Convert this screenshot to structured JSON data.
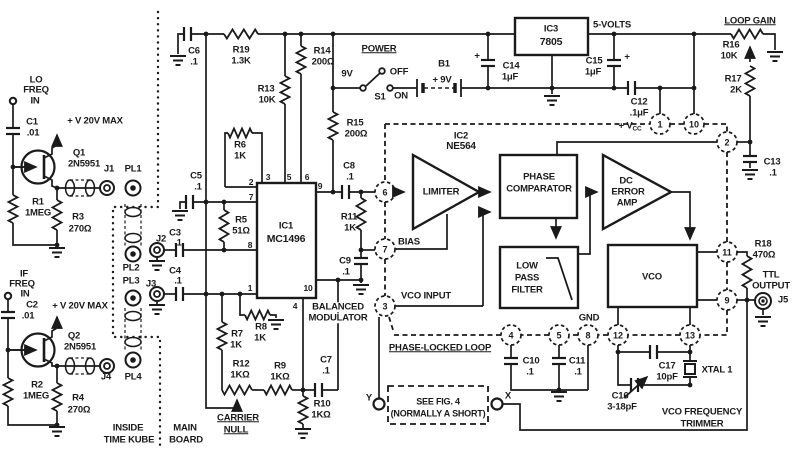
{
  "colors": {
    "ink": "#1a1a1a",
    "background": "#ffffff"
  },
  "labels": [
    {
      "id": "lo-1",
      "t": "LO",
      "x": 36,
      "y": 80
    },
    {
      "id": "lo-2",
      "t": "FREQ",
      "x": 36,
      "y": 90
    },
    {
      "id": "lo-3",
      "t": "IN",
      "x": 35,
      "y": 101
    },
    {
      "id": "c1-ref",
      "t": "C1",
      "x": 32,
      "y": 122
    },
    {
      "id": "c1-val",
      "t": ".01",
      "x": 33,
      "y": 133
    },
    {
      "id": "vmax-1",
      "t": "+ V 20V MAX",
      "x": 95,
      "y": 121
    },
    {
      "id": "q1-ref",
      "t": "Q1",
      "x": 79,
      "y": 153
    },
    {
      "id": "q1-val",
      "t": "2N5951",
      "x": 84,
      "y": 164
    },
    {
      "id": "j1-l",
      "t": "J1",
      "x": 109,
      "y": 169
    },
    {
      "id": "pl1-l",
      "t": "PL1",
      "x": 133,
      "y": 169
    },
    {
      "id": "r1-ref",
      "t": "R1",
      "x": 38,
      "y": 202
    },
    {
      "id": "r1-val",
      "t": "1MEG",
      "x": 38,
      "y": 213
    },
    {
      "id": "r3-ref",
      "t": "R3",
      "x": 78,
      "y": 217
    },
    {
      "id": "r3-val",
      "t": "270Ω",
      "x": 80,
      "y": 229
    },
    {
      "id": "if-1",
      "t": "IF",
      "x": 24,
      "y": 274
    },
    {
      "id": "if-2",
      "t": "FREQ",
      "x": 22,
      "y": 284
    },
    {
      "id": "if-3",
      "t": "IN",
      "x": 25,
      "y": 294
    },
    {
      "id": "c2-ref",
      "t": "C2",
      "x": 32,
      "y": 305
    },
    {
      "id": "c2-val",
      "t": ".01",
      "x": 28,
      "y": 316
    },
    {
      "id": "vmax-2",
      "t": "+ V 20V MAX",
      "x": 80,
      "y": 306
    },
    {
      "id": "q2-ref",
      "t": "Q2",
      "x": 74,
      "y": 336
    },
    {
      "id": "q2-val",
      "t": "2N5951",
      "x": 80,
      "y": 347
    },
    {
      "id": "j4-l",
      "t": "J4",
      "x": 106,
      "y": 377
    },
    {
      "id": "pl4-l",
      "t": "PL4",
      "x": 133,
      "y": 377
    },
    {
      "id": "r2-ref",
      "t": "R2",
      "x": 37,
      "y": 385
    },
    {
      "id": "r2-val",
      "t": "1MEG",
      "x": 36,
      "y": 396
    },
    {
      "id": "r4-ref",
      "t": "R4",
      "x": 78,
      "y": 398
    },
    {
      "id": "r4-val",
      "t": "270Ω",
      "x": 79,
      "y": 410
    },
    {
      "id": "pl2-l",
      "t": "PL2",
      "x": 131,
      "y": 268
    },
    {
      "id": "pl3-l",
      "t": "PL3",
      "x": 131,
      "y": 281
    },
    {
      "id": "j2-l",
      "t": "J2",
      "x": 161,
      "y": 239
    },
    {
      "id": "j3-l",
      "t": "J3",
      "x": 151,
      "y": 284
    },
    {
      "id": "inside-1",
      "t": "INSIDE",
      "x": 128,
      "y": 428
    },
    {
      "id": "inside-2",
      "t": "TIME KUBE",
      "x": 129,
      "y": 440
    },
    {
      "id": "main-1",
      "t": "MAIN",
      "x": 185,
      "y": 428
    },
    {
      "id": "main-2",
      "t": "BOARD",
      "x": 186,
      "y": 440
    },
    {
      "id": "c6-ref",
      "t": "C6",
      "x": 194,
      "y": 51
    },
    {
      "id": "c6-val",
      "t": ".1",
      "x": 194,
      "y": 62
    },
    {
      "id": "r19-ref",
      "t": "R19",
      "x": 241,
      "y": 50
    },
    {
      "id": "r19-val",
      "t": "1.3K",
      "x": 241,
      "y": 61
    },
    {
      "id": "r13-ref",
      "t": "R13",
      "x": 266,
      "y": 89
    },
    {
      "id": "r13-val",
      "t": "10K",
      "x": 267,
      "y": 100
    },
    {
      "id": "r14-ref",
      "t": "R14",
      "x": 322,
      "y": 51
    },
    {
      "id": "r14-val",
      "t": "200Ω",
      "x": 323,
      "y": 62
    },
    {
      "id": "r6-ref",
      "t": "R6",
      "x": 240,
      "y": 145
    },
    {
      "id": "r6-val",
      "t": "1K",
      "x": 240,
      "y": 156
    },
    {
      "id": "c5-ref",
      "t": "C5",
      "x": 196,
      "y": 176
    },
    {
      "id": "c5-val",
      "t": ".1",
      "x": 198,
      "y": 187
    },
    {
      "id": "r5-ref",
      "t": "R5",
      "x": 241,
      "y": 220
    },
    {
      "id": "r5-val",
      "t": "51Ω",
      "x": 241,
      "y": 231
    },
    {
      "id": "c3-ref",
      "t": "C3",
      "x": 175,
      "y": 233
    },
    {
      "id": "c3-val",
      "t": ".1",
      "x": 178,
      "y": 243
    },
    {
      "id": "c4-ref",
      "t": "C4",
      "x": 175,
      "y": 271
    },
    {
      "id": "c4-val",
      "t": ".1",
      "x": 178,
      "y": 281
    },
    {
      "id": "r7-ref",
      "t": "R7",
      "x": 237,
      "y": 334
    },
    {
      "id": "r7-val",
      "t": "1K",
      "x": 236,
      "y": 345
    },
    {
      "id": "r8-ref",
      "t": "R8",
      "x": 261,
      "y": 327
    },
    {
      "id": "r8-val",
      "t": "1K",
      "x": 260,
      "y": 338
    },
    {
      "id": "r12-ref",
      "t": "R12",
      "x": 241,
      "y": 364
    },
    {
      "id": "r12-val",
      "t": "1KΩ",
      "x": 240,
      "y": 375
    },
    {
      "id": "r9-ref",
      "t": "R9",
      "x": 280,
      "y": 366
    },
    {
      "id": "r9-val",
      "t": "1KΩ",
      "x": 280,
      "y": 377
    },
    {
      "id": "r10-ref",
      "t": "R10",
      "x": 322,
      "y": 404
    },
    {
      "id": "r10-val",
      "t": "1KΩ",
      "x": 321,
      "y": 415
    },
    {
      "id": "c7-ref",
      "t": "C7",
      "x": 326,
      "y": 360
    },
    {
      "id": "c7-val",
      "t": ".1",
      "x": 326,
      "y": 371
    },
    {
      "id": "carrier-1",
      "t": "CARRIER",
      "x": 238,
      "y": 418,
      "u": 1
    },
    {
      "id": "carrier-2",
      "t": "NULL",
      "x": 236,
      "y": 430,
      "u": 1
    },
    {
      "id": "ic1-ref",
      "t": "IC1",
      "x": 286,
      "y": 226
    },
    {
      "id": "ic1-val",
      "t": "MC1496",
      "x": 286,
      "y": 239,
      "fs": 10.5
    },
    {
      "id": "bal-1",
      "t": "BALANCED",
      "x": 338,
      "y": 307,
      "bg": 1
    },
    {
      "id": "bal-2",
      "t": "MODULATOR",
      "x": 338,
      "y": 318,
      "bg": 1
    },
    {
      "id": "ic1-p2",
      "t": "2",
      "x": 251,
      "y": 182,
      "fs": 8.5
    },
    {
      "id": "ic1-p7",
      "t": "7",
      "x": 251,
      "y": 197,
      "fs": 8.5
    },
    {
      "id": "ic1-p8",
      "t": "8",
      "x": 250,
      "y": 245,
      "fs": 8.5
    },
    {
      "id": "ic1-p1",
      "t": "1",
      "x": 250,
      "y": 288,
      "fs": 8.5
    },
    {
      "id": "ic1-p3",
      "t": "3",
      "x": 268,
      "y": 177,
      "fs": 8.5
    },
    {
      "id": "ic1-p5",
      "t": "5",
      "x": 289,
      "y": 177,
      "fs": 8.5
    },
    {
      "id": "ic1-p6",
      "t": "6",
      "x": 307,
      "y": 177,
      "fs": 8.5
    },
    {
      "id": "ic1-p9",
      "t": "9",
      "x": 320,
      "y": 186,
      "fs": 8.5
    },
    {
      "id": "ic1-p10",
      "t": "10",
      "x": 308,
      "y": 288,
      "fs": 8.5
    },
    {
      "id": "ic1-p4",
      "t": "4",
      "x": 295,
      "y": 306,
      "fs": 8.5
    },
    {
      "id": "r15-ref",
      "t": "R15",
      "x": 355,
      "y": 123
    },
    {
      "id": "r15-val",
      "t": "200Ω",
      "x": 356,
      "y": 134
    },
    {
      "id": "c8-ref",
      "t": "C8",
      "x": 349,
      "y": 166
    },
    {
      "id": "c8-val",
      "t": ".1",
      "x": 350,
      "y": 177
    },
    {
      "id": "r11-ref",
      "t": "R11",
      "x": 349,
      "y": 217
    },
    {
      "id": "r11-val",
      "t": "1K",
      "x": 350,
      "y": 228
    },
    {
      "id": "c9-ref",
      "t": "C9",
      "x": 345,
      "y": 261
    },
    {
      "id": "c9-val",
      "t": ".1",
      "x": 346,
      "y": 272
    },
    {
      "id": "power-l",
      "t": "POWER",
      "x": 379,
      "y": 49,
      "u": 1
    },
    {
      "id": "v9-l",
      "t": "9V",
      "x": 347,
      "y": 74
    },
    {
      "id": "off-l",
      "t": "OFF",
      "x": 399,
      "y": 72
    },
    {
      "id": "s1-l",
      "t": "S1",
      "x": 380,
      "y": 97
    },
    {
      "id": "on-l",
      "t": "ON",
      "x": 401,
      "y": 96
    },
    {
      "id": "b1-ref",
      "t": "B1",
      "x": 444,
      "y": 64
    },
    {
      "id": "b1-val",
      "t": "+ 9V",
      "x": 442,
      "y": 80
    },
    {
      "id": "c14-plus",
      "t": "+",
      "x": 477,
      "y": 56
    },
    {
      "id": "c14-ref",
      "t": "C14",
      "x": 511,
      "y": 66
    },
    {
      "id": "c14-val",
      "t": "1μF",
      "x": 510,
      "y": 77
    },
    {
      "id": "ic3-ref",
      "t": "IC3",
      "x": 551,
      "y": 29
    },
    {
      "id": "ic3-val",
      "t": "7805",
      "x": 551,
      "y": 42,
      "fs": 10.5
    },
    {
      "id": "v5-l",
      "t": "5-VOLTS",
      "x": 612,
      "y": 25
    },
    {
      "id": "c15-ref",
      "t": "C15",
      "x": 594,
      "y": 61
    },
    {
      "id": "c15-val",
      "t": "1μF",
      "x": 593,
      "y": 72
    },
    {
      "id": "c15-plus",
      "t": "+",
      "x": 627,
      "y": 57
    },
    {
      "id": "c12-ref",
      "t": "C12",
      "x": 639,
      "y": 102
    },
    {
      "id": "c12-val",
      "t": ".1μF",
      "x": 639,
      "y": 113
    },
    {
      "id": "vcc-l",
      "t": "+ V",
      "sub": "CC",
      "x": 630,
      "y": 127
    },
    {
      "id": "loopgain-l",
      "t": "LOOP GAIN",
      "x": 750,
      "y": 21,
      "u": 1
    },
    {
      "id": "r16-ref",
      "t": "R16",
      "x": 731,
      "y": 45
    },
    {
      "id": "r16-val",
      "t": "10K",
      "x": 729,
      "y": 56
    },
    {
      "id": "r17-ref",
      "t": "R17",
      "x": 733,
      "y": 79
    },
    {
      "id": "r17-val",
      "t": "2K",
      "x": 736,
      "y": 90
    },
    {
      "id": "ic2-ref",
      "t": "IC2",
      "x": 461,
      "y": 136
    },
    {
      "id": "ic2-val",
      "t": "NE564",
      "x": 461,
      "y": 147,
      "fs": 10
    },
    {
      "id": "limiter-l",
      "t": "LIMITER",
      "x": 441,
      "y": 192
    },
    {
      "id": "pc-1",
      "t": "PHASE",
      "x": 539,
      "y": 177
    },
    {
      "id": "pc-2",
      "t": "COMPARATOR",
      "x": 539,
      "y": 189
    },
    {
      "id": "dc-1",
      "t": "DC",
      "x": 626,
      "y": 181
    },
    {
      "id": "dc-2",
      "t": "ERROR",
      "x": 628,
      "y": 192
    },
    {
      "id": "dc-3",
      "t": "AMP",
      "x": 627,
      "y": 203
    },
    {
      "id": "lpf-1",
      "t": "LOW",
      "x": 527,
      "y": 266
    },
    {
      "id": "lpf-2",
      "t": "PASS",
      "x": 527,
      "y": 278
    },
    {
      "id": "lpf-3",
      "t": "FILTER",
      "x": 527,
      "y": 290
    },
    {
      "id": "vco-l",
      "t": "VCO",
      "x": 652,
      "y": 277
    },
    {
      "id": "bias-l",
      "t": "BIAS",
      "x": 409,
      "y": 242
    },
    {
      "id": "vcoin-l",
      "t": "VCO INPUT",
      "x": 426,
      "y": 296
    },
    {
      "id": "pll-l",
      "t": "PHASE-LOCKED LOOP",
      "x": 440,
      "y": 348,
      "u": 1
    },
    {
      "id": "gnd-l",
      "t": "GND",
      "x": 589,
      "y": 318
    },
    {
      "id": "c10-ref",
      "t": "C10",
      "x": 531,
      "y": 361
    },
    {
      "id": "c10-val",
      "t": ".1",
      "x": 530,
      "y": 372
    },
    {
      "id": "c11-ref",
      "t": "C11",
      "x": 577,
      "y": 361
    },
    {
      "id": "c11-val",
      "t": ".1",
      "x": 578,
      "y": 372
    },
    {
      "id": "c13-ref",
      "t": "C13",
      "x": 772,
      "y": 162
    },
    {
      "id": "c13-val",
      "t": ".1",
      "x": 773,
      "y": 173
    },
    {
      "id": "r18-ref",
      "t": "R18",
      "x": 763,
      "y": 244
    },
    {
      "id": "r18-val",
      "t": "470Ω",
      "x": 764,
      "y": 255
    },
    {
      "id": "ttl-1",
      "t": "TTL",
      "x": 771,
      "y": 275
    },
    {
      "id": "ttl-2",
      "t": "OUTPUT",
      "x": 771,
      "y": 286
    },
    {
      "id": "j5-l",
      "t": "J5",
      "x": 783,
      "y": 300
    },
    {
      "id": "c17-ref",
      "t": "C17",
      "x": 667,
      "y": 366
    },
    {
      "id": "c17-val",
      "t": "10pF",
      "x": 667,
      "y": 377
    },
    {
      "id": "xtal-l",
      "t": "XTAL 1",
      "x": 717,
      "y": 370
    },
    {
      "id": "c16-ref",
      "t": "C16",
      "x": 620,
      "y": 396
    },
    {
      "id": "c16-val",
      "t": "3-18pF",
      "x": 622,
      "y": 407
    },
    {
      "id": "vft-1",
      "t": "VCO FREQUENCY",
      "x": 702,
      "y": 412,
      "bg": 1
    },
    {
      "id": "vft-2",
      "t": "TRIMMER",
      "x": 702,
      "y": 424
    },
    {
      "id": "fig4-1",
      "t": "SEE FIG. 4",
      "x": 438,
      "y": 402,
      "fs": 9
    },
    {
      "id": "fig4-2",
      "t": "(NORMALLY A SHORT)",
      "x": 438,
      "y": 414,
      "fs": 9
    },
    {
      "id": "x-l",
      "t": "X",
      "x": 508,
      "y": 396
    },
    {
      "id": "y-l",
      "t": "Y",
      "x": 369,
      "y": 398
    }
  ],
  "pll_pins": [
    {
      "n": "6",
      "x": 385,
      "y": 192
    },
    {
      "n": "7",
      "x": 385,
      "y": 249
    },
    {
      "n": "3",
      "x": 385,
      "y": 306
    },
    {
      "n": "4",
      "x": 511,
      "y": 335
    },
    {
      "n": "5",
      "x": 559,
      "y": 335
    },
    {
      "n": "8",
      "x": 588,
      "y": 335
    },
    {
      "n": "12",
      "x": 618,
      "y": 335
    },
    {
      "n": "13",
      "x": 690,
      "y": 335
    },
    {
      "n": "11",
      "x": 727,
      "y": 252
    },
    {
      "n": "9",
      "x": 727,
      "y": 300
    },
    {
      "n": "2",
      "x": 727,
      "y": 142
    },
    {
      "n": "1",
      "x": 660,
      "y": 124
    },
    {
      "n": "10",
      "x": 694,
      "y": 124
    }
  ]
}
